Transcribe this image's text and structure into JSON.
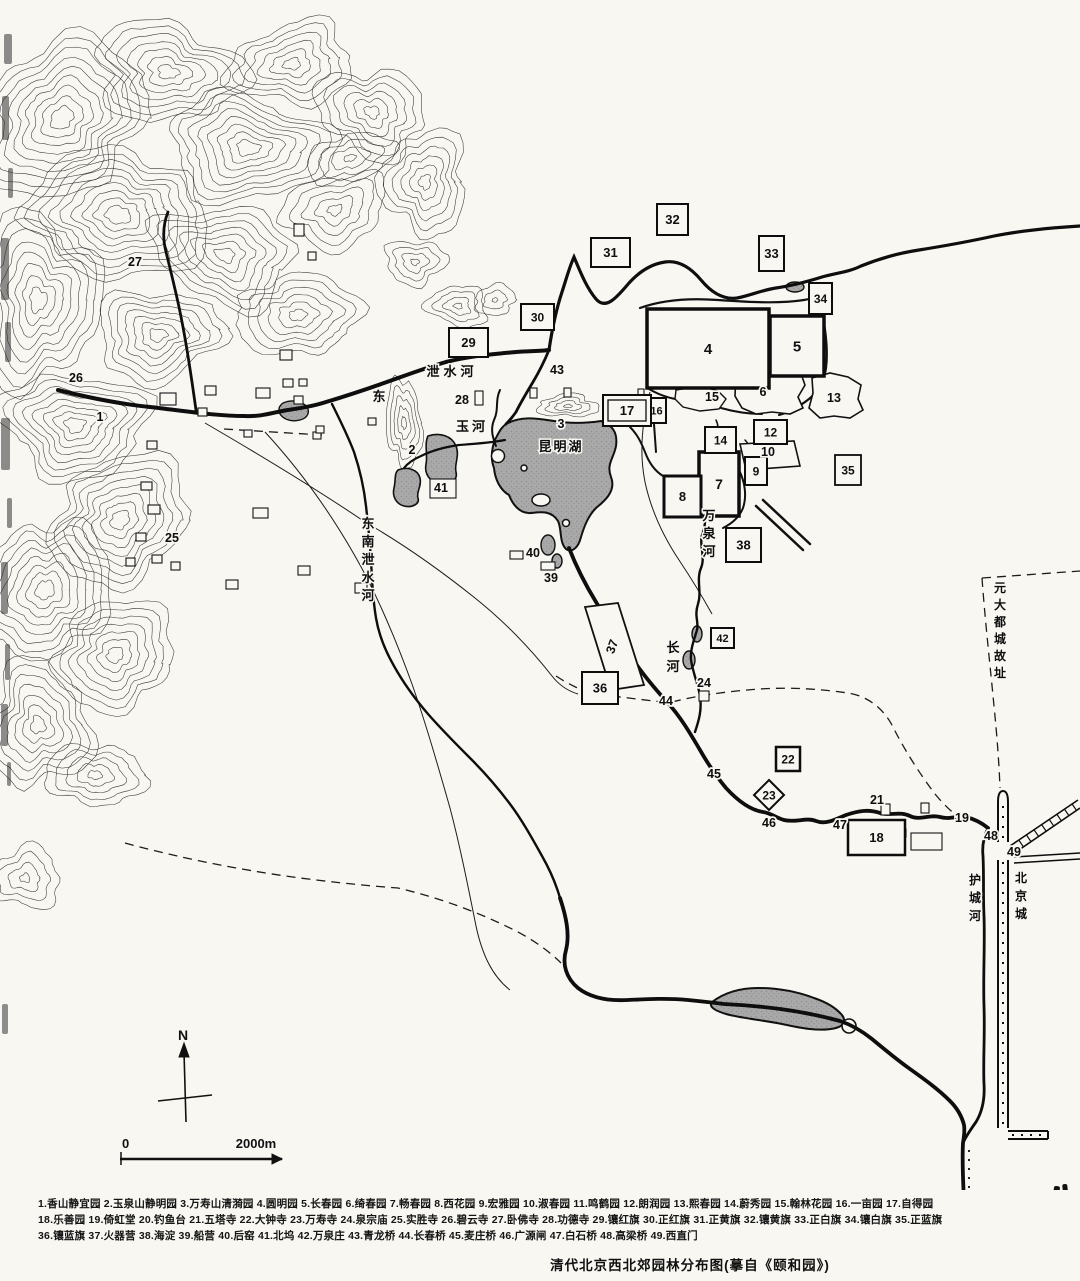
{
  "title": "清代北京西北郊园林分布图(摹自《颐和园》)",
  "compass": {
    "north_label": "N"
  },
  "scale_bar": {
    "start_label": "0",
    "end_label": "2000m"
  },
  "markers": {
    "boxed": [
      {
        "n": "4",
        "x": 647,
        "y": 309,
        "w": 122,
        "h": 79,
        "sw": 3.5,
        "fs": 15
      },
      {
        "n": "5",
        "x": 770,
        "y": 316,
        "w": 54,
        "h": 60,
        "sw": 3.5,
        "fs": 15
      },
      {
        "n": "7",
        "x": 699,
        "y": 452,
        "w": 40,
        "h": 64,
        "sw": 3.5,
        "fs": 14
      },
      {
        "n": "8",
        "x": 664,
        "y": 476,
        "w": 37,
        "h": 41,
        "sw": 3,
        "fs": 13
      },
      {
        "n": "9",
        "x": 745,
        "y": 457,
        "w": 22,
        "h": 28,
        "sw": 2,
        "fs": 12
      },
      {
        "n": "12",
        "x": 754,
        "y": 420,
        "w": 33,
        "h": 24,
        "sw": 2,
        "fs": 12
      },
      {
        "n": "14",
        "x": 705,
        "y": 427,
        "w": 31,
        "h": 26,
        "sw": 2,
        "fs": 12
      },
      {
        "n": "16",
        "x": 647,
        "y": 398,
        "w": 19,
        "h": 25,
        "sw": 2,
        "fs": 11
      },
      {
        "n": "17",
        "x": 603,
        "y": 395,
        "w": 48,
        "h": 31,
        "sw": 2,
        "fs": 13,
        "double": true
      },
      {
        "n": "18",
        "x": 848,
        "y": 820,
        "w": 57,
        "h": 35,
        "sw": 2.5,
        "fs": 13
      },
      {
        "n": "22",
        "x": 776,
        "y": 747,
        "w": 24,
        "h": 24,
        "sw": 2.5,
        "fs": 12
      },
      {
        "n": "29",
        "x": 449,
        "y": 328,
        "w": 39,
        "h": 29,
        "sw": 2,
        "fs": 13
      },
      {
        "n": "30",
        "x": 521,
        "y": 304,
        "w": 33,
        "h": 26,
        "sw": 2,
        "fs": 12
      },
      {
        "n": "31",
        "x": 591,
        "y": 238,
        "w": 39,
        "h": 29,
        "sw": 2,
        "fs": 13
      },
      {
        "n": "32",
        "x": 657,
        "y": 204,
        "w": 31,
        "h": 31,
        "sw": 2,
        "fs": 13
      },
      {
        "n": "33",
        "x": 759,
        "y": 236,
        "w": 25,
        "h": 35,
        "sw": 2,
        "fs": 13
      },
      {
        "n": "34",
        "x": 809,
        "y": 283,
        "w": 23,
        "h": 31,
        "sw": 2,
        "fs": 12
      },
      {
        "n": "35",
        "x": 835,
        "y": 455,
        "w": 26,
        "h": 30,
        "sw": 1.8,
        "fs": 12
      },
      {
        "n": "36",
        "x": 582,
        "y": 672,
        "w": 36,
        "h": 32,
        "sw": 2,
        "fs": 13
      },
      {
        "n": "38",
        "x": 726,
        "y": 528,
        "w": 35,
        "h": 34,
        "sw": 2,
        "fs": 13
      },
      {
        "n": "42",
        "x": 711,
        "y": 628,
        "w": 23,
        "h": 20,
        "sw": 2,
        "fs": 11
      }
    ],
    "diamond": {
      "n": "23",
      "cx": 769,
      "cy": 795,
      "r": 15,
      "fs": 12
    },
    "plain": [
      {
        "n": "1",
        "x": 100,
        "y": 421
      },
      {
        "n": "2",
        "x": 412,
        "y": 454
      },
      {
        "n": "3",
        "x": 561,
        "y": 428
      },
      {
        "n": "6",
        "x": 763,
        "y": 396
      },
      {
        "n": "10",
        "x": 768,
        "y": 456
      },
      {
        "n": "13",
        "x": 834,
        "y": 402
      },
      {
        "n": "15",
        "x": 712,
        "y": 401
      },
      {
        "n": "19",
        "x": 962,
        "y": 822
      },
      {
        "n": "21",
        "x": 877,
        "y": 804
      },
      {
        "n": "24",
        "x": 704,
        "y": 687
      },
      {
        "n": "25",
        "x": 172,
        "y": 542
      },
      {
        "n": "26",
        "x": 76,
        "y": 382
      },
      {
        "n": "27",
        "x": 135,
        "y": 266
      },
      {
        "n": "28",
        "x": 462,
        "y": 404
      },
      {
        "n": "37",
        "x": 616,
        "y": 648,
        "rot": -70
      },
      {
        "n": "39",
        "x": 551,
        "y": 582
      },
      {
        "n": "40",
        "x": 533,
        "y": 557
      },
      {
        "n": "41",
        "x": 441,
        "y": 492
      },
      {
        "n": "43",
        "x": 557,
        "y": 374
      },
      {
        "n": "44",
        "x": 666,
        "y": 705
      },
      {
        "n": "45",
        "x": 714,
        "y": 778
      },
      {
        "n": "46",
        "x": 769,
        "y": 827
      },
      {
        "n": "47",
        "x": 840,
        "y": 829
      },
      {
        "n": "48",
        "x": 991,
        "y": 840
      },
      {
        "n": "49",
        "x": 1014,
        "y": 856
      }
    ],
    "areas": [
      {
        "t": "泄水河",
        "x": 452,
        "y": 376,
        "dir": "h",
        "ls": 4,
        "fs": 13
      },
      {
        "t": "东",
        "x": 379,
        "y": 401,
        "dir": "h",
        "ls": 0,
        "fs": 13
      },
      {
        "t": "玉河",
        "x": 472,
        "y": 431,
        "dir": "h",
        "ls": 3,
        "fs": 13
      },
      {
        "t": "昆明湖",
        "x": 561,
        "y": 451,
        "dir": "h",
        "ls": 2,
        "fs": 13
      },
      {
        "t": "东南泄水河",
        "x": 368,
        "y": 528,
        "dir": "v",
        "fs": 13,
        "step": 18
      },
      {
        "t": "万泉河",
        "x": 709,
        "y": 520,
        "dir": "v",
        "fs": 13,
        "step": 18
      },
      {
        "t": "长河",
        "x": 673,
        "y": 652,
        "dir": "v",
        "fs": 13,
        "step": 19
      },
      {
        "t": "元大都城故址",
        "x": 1000,
        "y": 592,
        "dir": "v",
        "fs": 12,
        "step": 17
      },
      {
        "t": "护城河",
        "x": 975,
        "y": 884,
        "dir": "v",
        "fs": 12,
        "step": 18
      },
      {
        "t": "北京城",
        "x": 1021,
        "y": 882,
        "dir": "v",
        "fs": 12,
        "step": 18
      }
    ]
  },
  "legend_rows": [
    [
      {
        "n": "1",
        "name": "香山静宜园"
      },
      {
        "n": "2",
        "name": "玉泉山静明园"
      },
      {
        "n": "3",
        "name": "万寿山清漪园"
      },
      {
        "n": "4",
        "name": "圆明园"
      },
      {
        "n": "5",
        "name": "长春园"
      },
      {
        "n": "6",
        "name": "绮春园"
      },
      {
        "n": "7",
        "name": "畅春园"
      },
      {
        "n": "8",
        "name": "西花园"
      },
      {
        "n": "9",
        "name": "宏雅园"
      },
      {
        "n": "10",
        "name": "淑春园"
      },
      {
        "n": "11",
        "name": "鸣鹤园"
      },
      {
        "n": "12",
        "name": "朗润园"
      },
      {
        "n": "13",
        "name": "熙春园"
      },
      {
        "n": "14",
        "name": "蔚秀园"
      },
      {
        "n": "15",
        "name": "翰林花园"
      },
      {
        "n": "16",
        "name": "一亩园"
      },
      {
        "n": "17",
        "name": "自得园"
      }
    ],
    [
      {
        "n": "18",
        "name": "乐善园"
      },
      {
        "n": "19",
        "name": "倚虹堂"
      },
      {
        "n": "20",
        "name": "钓鱼台"
      },
      {
        "n": "21",
        "name": "五塔寺"
      },
      {
        "n": "22",
        "name": "大钟寺"
      },
      {
        "n": "23",
        "name": "万寿寺"
      },
      {
        "n": "24",
        "name": "泉宗庙"
      },
      {
        "n": "25",
        "name": "实胜寺"
      },
      {
        "n": "26",
        "name": "碧云寺"
      },
      {
        "n": "27",
        "name": "卧佛寺"
      },
      {
        "n": "28",
        "name": "功德寺"
      },
      {
        "n": "29",
        "name": "镶红旗"
      },
      {
        "n": "30",
        "name": "正红旗"
      },
      {
        "n": "31",
        "name": "正黄旗"
      },
      {
        "n": "32",
        "name": "镶黄旗"
      },
      {
        "n": "33",
        "name": "正白旗"
      },
      {
        "n": "34",
        "name": "镶白旗"
      },
      {
        "n": "35",
        "name": "正蓝旗"
      }
    ],
    [
      {
        "n": "36",
        "name": "镶蓝旗"
      },
      {
        "n": "37",
        "name": "火器营"
      },
      {
        "n": "38",
        "name": "海淀"
      },
      {
        "n": "39",
        "name": "船营"
      },
      {
        "n": "40",
        "name": "后窑"
      },
      {
        "n": "41",
        "name": "北坞"
      },
      {
        "n": "42",
        "name": "万泉庄"
      },
      {
        "n": "43",
        "name": "青龙桥"
      },
      {
        "n": "44",
        "name": "长春桥"
      },
      {
        "n": "45",
        "name": "麦庄桥"
      },
      {
        "n": "46",
        "name": "广源闸"
      },
      {
        "n": "47",
        "name": "白石桥"
      },
      {
        "n": "48",
        "name": "高梁桥"
      },
      {
        "n": "49",
        "name": "西直门"
      }
    ]
  ]
}
